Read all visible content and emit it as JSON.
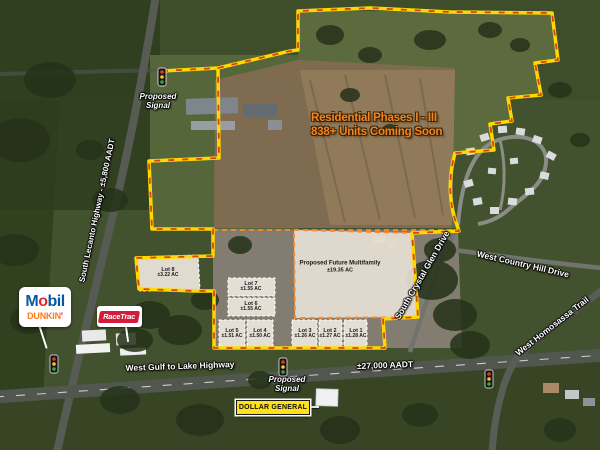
{
  "map": {
    "annotations": {
      "residential_line1": "Residential Phases I - III",
      "residential_line2": "838+ Units Coming Soon",
      "proposed_signal_top": "Proposed Signal",
      "proposed_signal_bottom": "Proposed Signal"
    },
    "roads": {
      "west_gulf": "West Gulf to Lake Highway",
      "west_gulf_aadt": "±27,000 AADT",
      "lecanto": "South Lecanto Highway - ±5,800 AADT",
      "crystal_glen": "South Crystal Glen Drive",
      "country_hill": "West Country Hill Drive",
      "homosassa": "West Homosassa Trail"
    },
    "parcels": {
      "multifamily": {
        "name": "Proposed Future Multifamily",
        "acreage": "±19.35 AC"
      },
      "lots": [
        {
          "name": "Lot 8",
          "acreage": "±3.22 AC"
        },
        {
          "name": "Lot 7",
          "acreage": "±1.55 AC"
        },
        {
          "name": "Lot 6",
          "acreage": "±1.55 AC"
        },
        {
          "name": "Lot 5",
          "acreage": "±1.51 AC"
        },
        {
          "name": "Lot 4",
          "acreage": "±1.50 AC"
        },
        {
          "name": "Lot 3",
          "acreage": "±1.26 AC"
        },
        {
          "name": "Lot 2",
          "acreage": "±1.27 AC"
        },
        {
          "name": "Lot 1",
          "acreage": "±1.28 AC"
        }
      ]
    },
    "tenants": {
      "mobil_m": "M",
      "mobil_o": "o",
      "mobil_bil": "bil",
      "dunkin_text": "DUNKIN",
      "dunkin_apostrophe": "'",
      "racetrac": "RaceTrac",
      "dollar_general": "DOLLAR GENERAL"
    },
    "colors": {
      "boundary_yellow": "#ffd800",
      "boundary_red_dash": "#d8430e",
      "parcel_dash_orange": "#ff8a2a",
      "residential_text_orange": "#f5831e",
      "dollar_general_yellow": "#ffe11a"
    }
  }
}
